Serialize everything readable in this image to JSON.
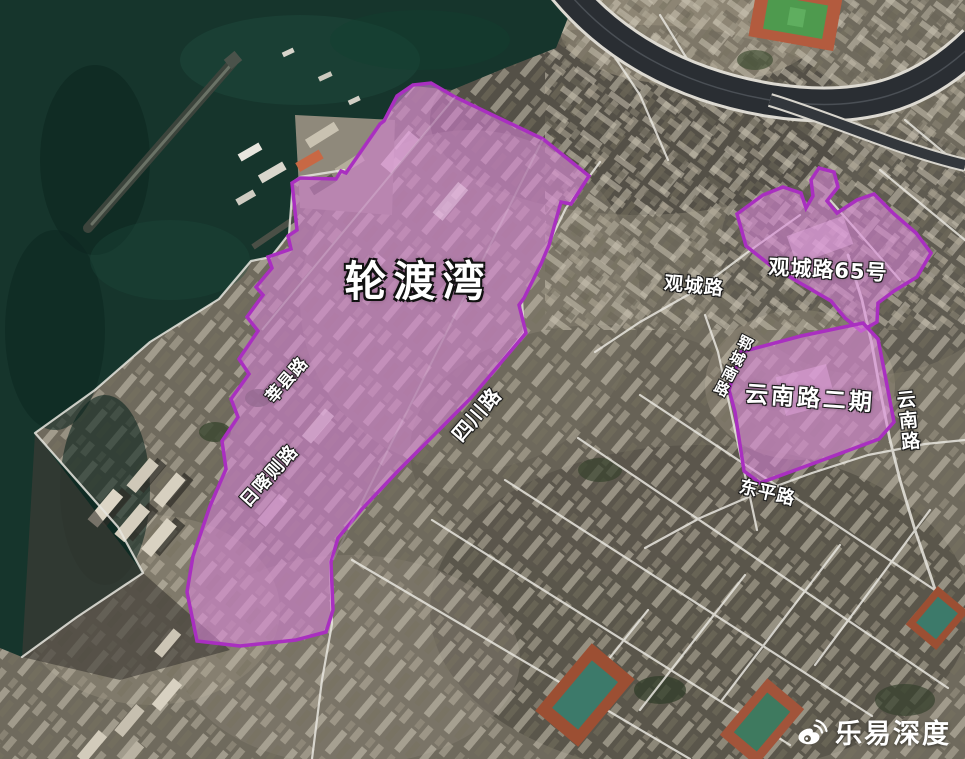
{
  "map": {
    "description": "satellite-map-with-renewal-zones",
    "zones": [
      {
        "id": "lunduwan",
        "name": "轮渡湾"
      },
      {
        "id": "guanchenglu65",
        "name": "观城路65号"
      },
      {
        "id": "yunnanlu-phase2",
        "name": "云南路二期"
      }
    ],
    "roads": [
      {
        "id": "guanchenglu",
        "name": "观城路"
      },
      {
        "id": "sichuanlu",
        "name": "四川路"
      },
      {
        "id": "xinxianlu",
        "name": "莘县路"
      },
      {
        "id": "rikazelu",
        "name": "日喀则路"
      },
      {
        "id": "dongpinglu",
        "name": "东平路"
      },
      {
        "id": "yunchengnanlu",
        "name": "郓城南路"
      },
      {
        "id": "yunnanlu",
        "name": "云南路"
      }
    ],
    "colors": {
      "zone_fill": "#d883d8",
      "zone_border": "#a92fc0",
      "water": "#16352c",
      "label": "#ffffff",
      "road_line": "#e8e6df"
    }
  },
  "watermark": {
    "text": "乐易深度",
    "icon": "weibo-icon"
  }
}
